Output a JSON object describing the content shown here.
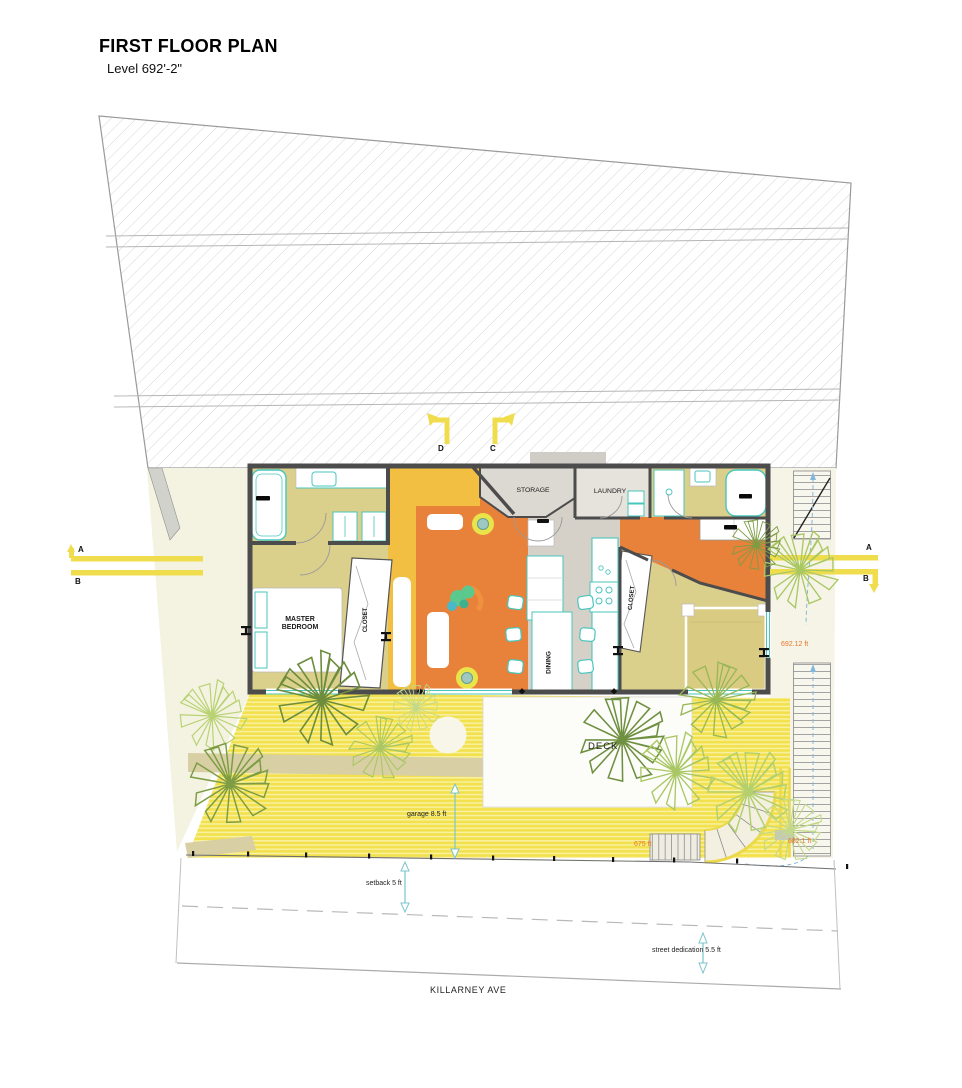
{
  "drawing": {
    "title": "FIRST FLOOR PLAN",
    "level": "Level 692'-2\""
  },
  "section_markers": {
    "d": "D",
    "c": "C",
    "a_left": "A",
    "b_left": "B",
    "a_right": "A",
    "b_right": "B"
  },
  "rooms": {
    "master_bedroom": "MASTER BEDROOM",
    "master_closet": "CLOSET",
    "storage": "STORAGE",
    "laundry": "LAUNDRY",
    "dining": "DINING",
    "bedroom2_closet": "CLOSET",
    "deck": "DECK"
  },
  "elevations": {
    "stair_landing": "692.12 ft",
    "deck_edge": "675 ft",
    "stair_bottom": "682.1 ft"
  },
  "dimensions": {
    "garage_depth": "garage 8.5 ft",
    "front_setback": "setback 5 ft",
    "street_dedication": "street dedication 5.5 ft"
  },
  "street": {
    "name": "KILLARNEY AVE"
  },
  "colors": {
    "section_line_yellow": "#F2DE4E",
    "living_orange": "#E8823B",
    "accent_yellow_orange": "#F2BF42",
    "room_khaki": "#DBCF8C",
    "fixture_teal": "#49C5BD",
    "deck_yellow": "#F3E24F",
    "elevation_text_orange": "#E8772B",
    "dimension_teal": "#7CC4CC",
    "tree_green": "#9BBF4E"
  }
}
